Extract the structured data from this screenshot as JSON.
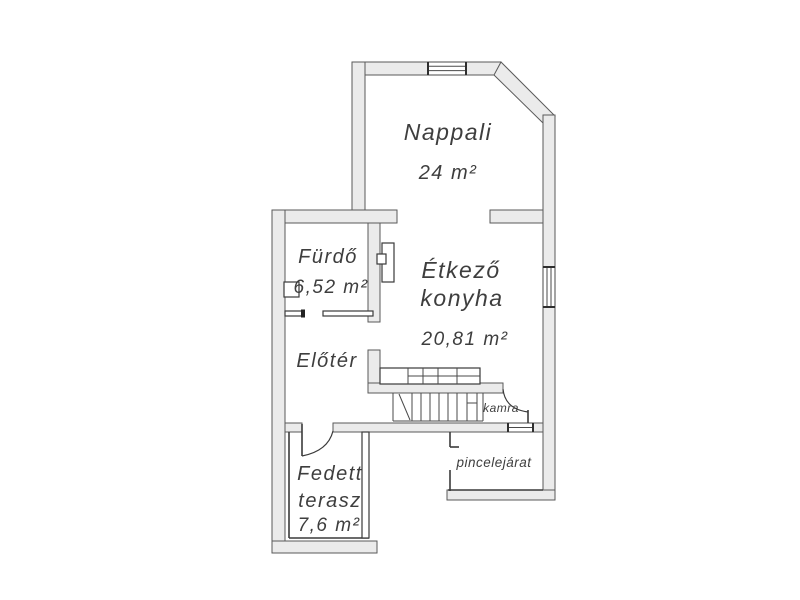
{
  "title": "Floor plan",
  "colors": {
    "background": "#ffffff",
    "wall_fill": "#ebebeb",
    "wall_outline": "#5a5a5a",
    "text": "#3e3e3e"
  },
  "floorplan": {
    "rooms": {
      "nappali": {
        "label": "Nappali",
        "area": "24 m²"
      },
      "furdo": {
        "label": "Fürdő",
        "area": "6,52 m²"
      },
      "etkezo_konyha": {
        "label_line1": "Étkező",
        "label_line2": "konyha",
        "area": "20,81 m²"
      },
      "eloter": {
        "label": "Előtér"
      },
      "kamra": {
        "label": "kamra"
      },
      "pincelejarat": {
        "label": "pincelejárat"
      },
      "fedett_terasz": {
        "label_line1": "Fedett",
        "label_line2": "terasz",
        "area": "7,6 m²"
      }
    }
  }
}
